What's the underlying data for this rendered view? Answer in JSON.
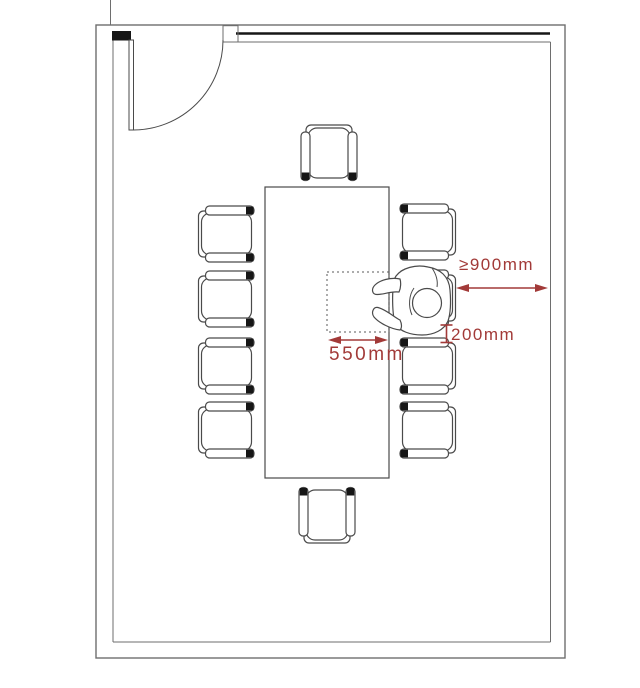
{
  "colors": {
    "dimension": "#a23a38",
    "wall_line": "#6e6e6e",
    "furniture_line": "#4a4a4a",
    "dark_fill": "#161616",
    "background": "#ffffff"
  },
  "dimensions": {
    "clearance_behind_chair": {
      "label": "≥900mm",
      "value_mm": 900,
      "constraint": "min"
    },
    "chair_spacing": {
      "label": "200mm",
      "value_mm": 200
    },
    "place_setting_width": {
      "label": "550mm",
      "value_mm": 550
    }
  },
  "furniture": {
    "table": {
      "x": 265,
      "y": 187,
      "width": 124,
      "height": 291
    },
    "place_setting_zone": {
      "x": 327,
      "y": 272,
      "width": 62,
      "height": 60
    },
    "door": {
      "hinge_x": 133,
      "hinge_y": 40,
      "radius": 90
    },
    "chairs": [
      {
        "id": "chair-left-1",
        "cx": 226.5,
        "cy": 234,
        "rotation": 0
      },
      {
        "id": "chair-left-2",
        "cx": 226.5,
        "cy": 299,
        "rotation": 0
      },
      {
        "id": "chair-left-3",
        "cx": 226.5,
        "cy": 366,
        "rotation": 0
      },
      {
        "id": "chair-left-4",
        "cx": 226.5,
        "cy": 430,
        "rotation": 0
      },
      {
        "id": "chair-right-1",
        "cx": 427.5,
        "cy": 232,
        "rotation": 180
      },
      {
        "id": "chair-right-2",
        "cx": 427.5,
        "cy": 298,
        "rotation": 180
      },
      {
        "id": "chair-right-3",
        "cx": 427.5,
        "cy": 366,
        "rotation": 180
      },
      {
        "id": "chair-right-4",
        "cx": 427.5,
        "cy": 430,
        "rotation": 180
      },
      {
        "id": "chair-top",
        "cx": 329,
        "cy": 153,
        "rotation": 90
      },
      {
        "id": "chair-bottom",
        "cx": 327,
        "cy": 515,
        "rotation": 270
      }
    ]
  }
}
